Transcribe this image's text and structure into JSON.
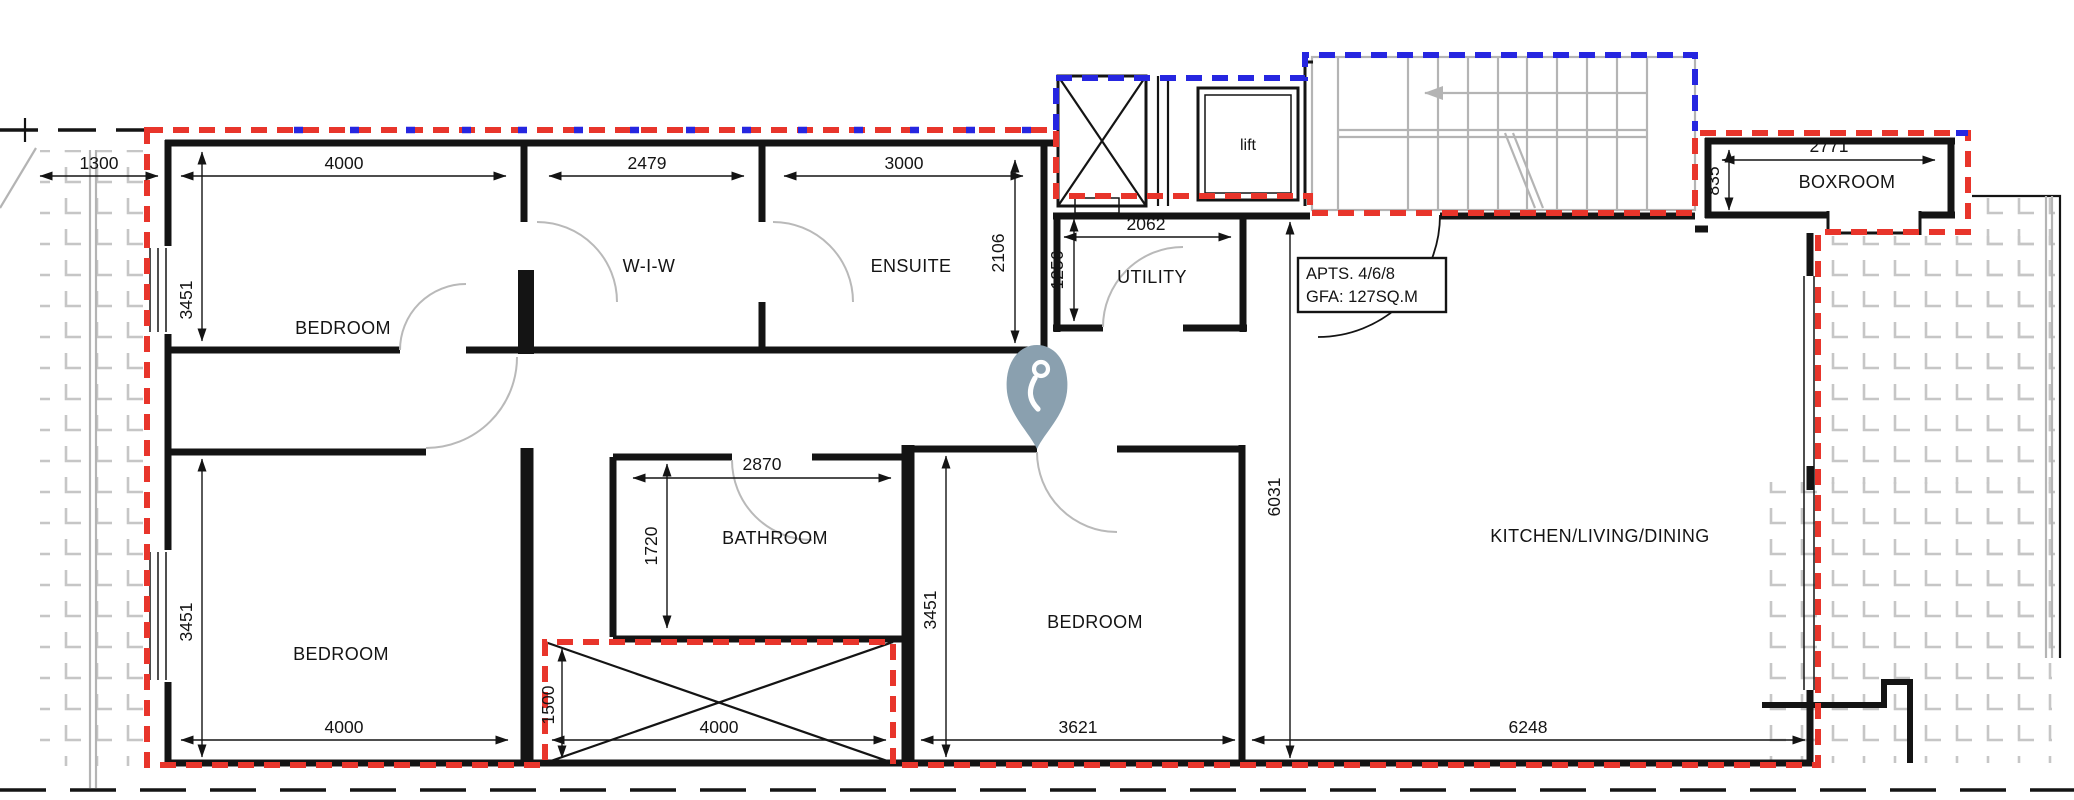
{
  "plan": {
    "rooms": {
      "bedroom1": "BEDROOM",
      "wiw": "W-I-W",
      "ensuite": "ENSUITE",
      "utility": "UTILITY",
      "lift": "lift",
      "boxroom": "BOXROOM",
      "bathroom": "BATHROOM",
      "bedroom2": "BEDROOM",
      "bedroom3": "BEDROOM",
      "kitchen": "KITCHEN/LIVING/DINING"
    },
    "annotation": {
      "line1": "APTS. 4/6/8",
      "line2": "GFA: 127SQ.M"
    },
    "dims": {
      "terrace_left": "1300",
      "bedroom1_w": "4000",
      "wiw_w": "2479",
      "ensuite_w": "3000",
      "ensuite_h": "2106",
      "utility_w": "2062",
      "utility_h": "1256",
      "bedroom1_h": "3451",
      "bedroom2_h": "3451",
      "bedroom3_h": "3451",
      "bathroom_w": "2870",
      "bathroom_h": "1720",
      "kitchen_h": "6031",
      "boxroom_h": "835",
      "boxroom_w": "2771",
      "bedroom2_w": "4000",
      "shaft_h": "1500",
      "shaft_w": "4000",
      "bedroom3_w": "3621",
      "kitchen_w": "6248"
    },
    "colors": {
      "boundary_red": "#e8352b",
      "boundary_blue": "#2626e0",
      "wall": "#141414",
      "hatch": "#c6c6c6",
      "stair": "#b4b4b4",
      "door_arc": "#b9b9b9",
      "pin": "#8aa0af"
    }
  }
}
